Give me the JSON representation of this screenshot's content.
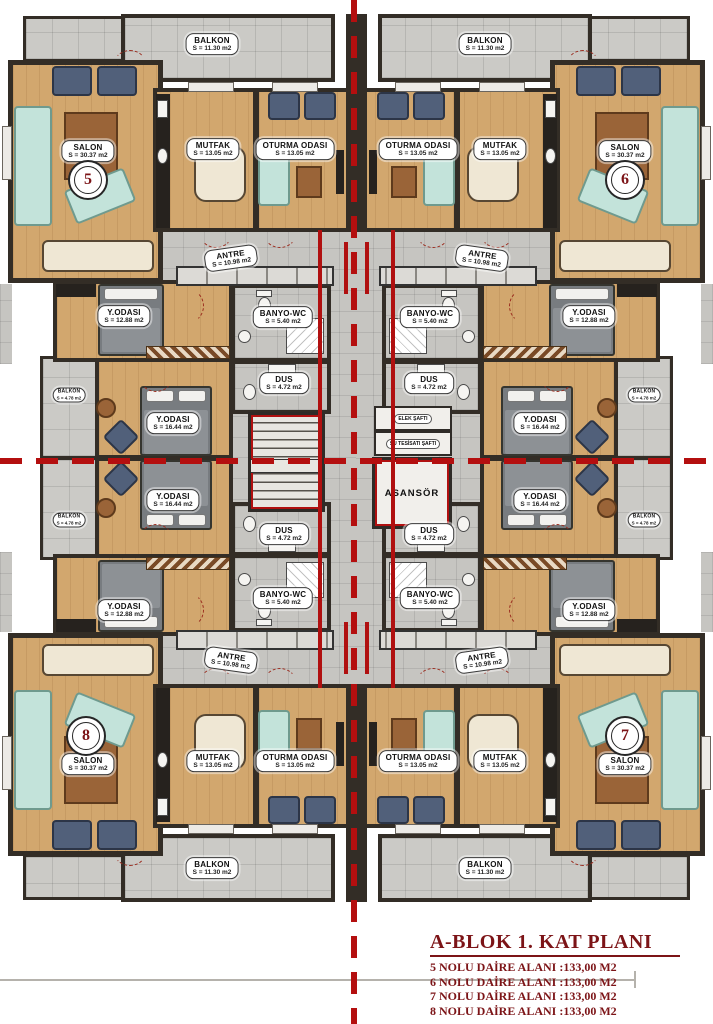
{
  "plan": {
    "units": {
      "u5": "5",
      "u6": "6",
      "u7": "7",
      "u8": "8"
    },
    "rooms": {
      "salon": {
        "name": "SALON",
        "area": "S = 30.37 m2"
      },
      "mutfak": {
        "name": "MUTFAK",
        "area": "S = 13.05 m2"
      },
      "oturma": {
        "name": "OTURMA ODASI",
        "area": "S = 13.05 m2"
      },
      "antre": {
        "name": "ANTRE",
        "area": "S = 10.98 m2"
      },
      "banyo": {
        "name": "BANYO-WC",
        "area": "S = 5.40 m2"
      },
      "dus": {
        "name": "DUS",
        "area": "S = 4.72 m2"
      },
      "yatak1": {
        "name": "Y.ODASI",
        "area": "S = 12.88 m2"
      },
      "yatak2": {
        "name": "Y.ODASI",
        "area": "S = 16.44 m2"
      },
      "balkon": {
        "name": "BALKON",
        "area": "S = 11.30 m2"
      },
      "balkon_yan": {
        "name": "BALKON",
        "area": "S = 4.78 m2"
      }
    },
    "core": {
      "elevator": "ASANSÖR",
      "shaft_elec": "ELEK ŞAFTI",
      "shaft_water": "SU TESİSATI ŞAFTI"
    }
  },
  "title_block": {
    "title": "A-BLOK 1. KAT PLANI",
    "entries": [
      "5  NOLU DAİRE ALANI :133,00  M2",
      "6 NOLU DAİRE ALANI :133,00  M2",
      "7 NOLU DAİRE ALANI :133,00  M2",
      "8 NOLU DAİRE ALANI :133,00  M2"
    ]
  },
  "colors": {
    "axis_red": "#b40f0f",
    "title_red": "#7c1417",
    "wall_dark": "#332d26",
    "wood_floor": "#d2a76e",
    "tile_gray": "#c6c5c1",
    "sofa_teal": "#c3e3da",
    "accent_red": "#b01010"
  }
}
